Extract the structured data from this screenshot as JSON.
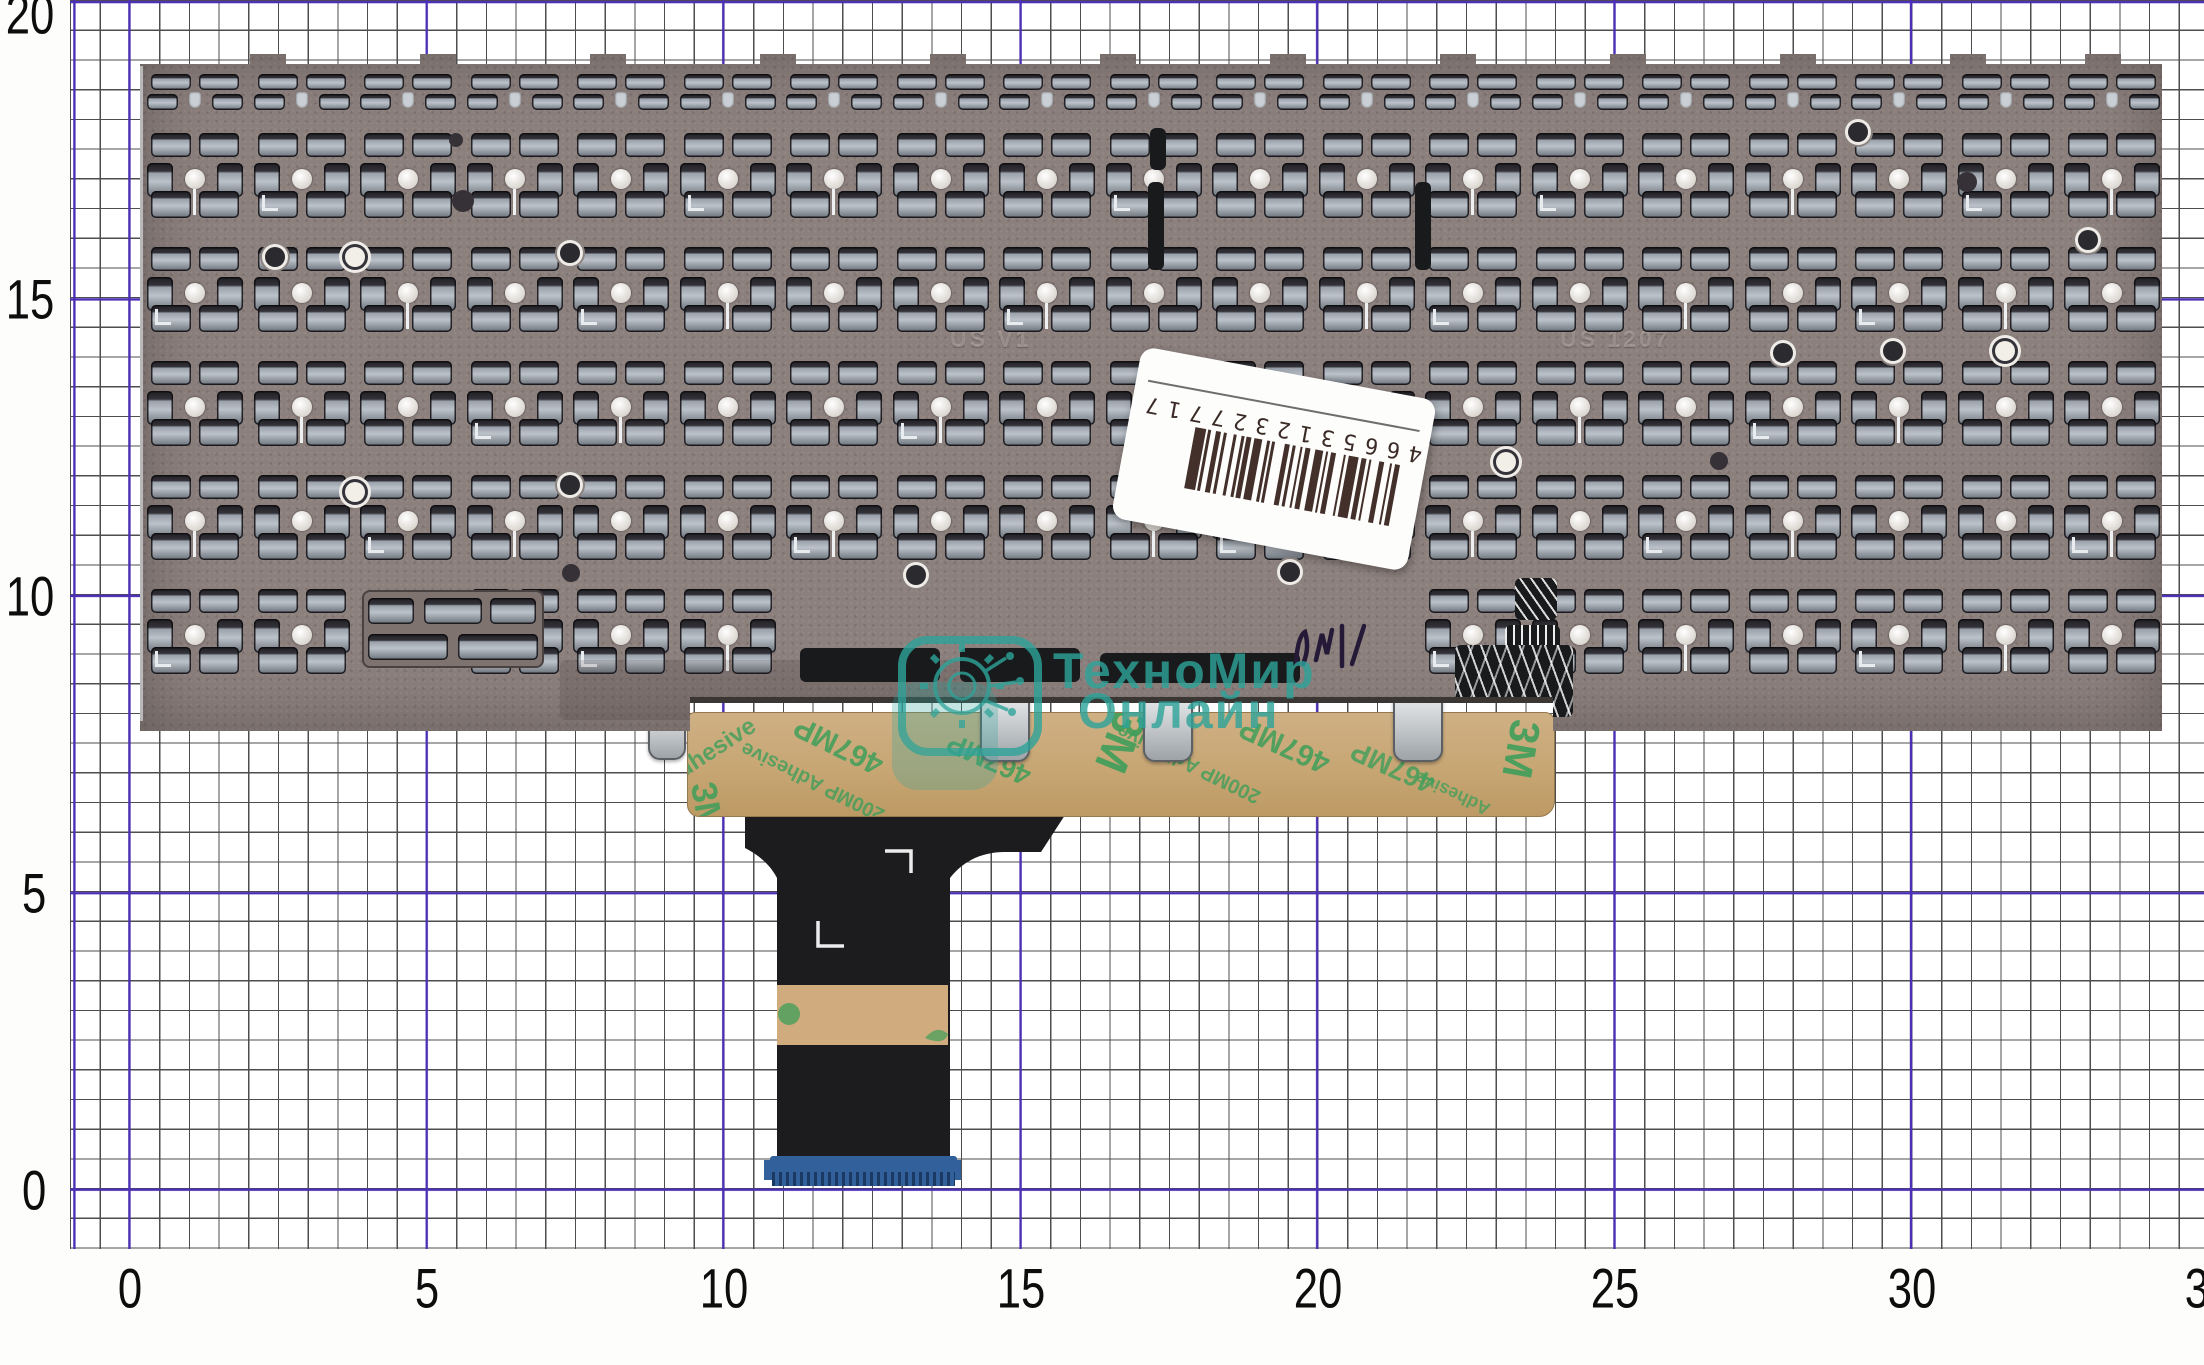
{
  "ruler": {
    "x_labels": [
      "0",
      "5",
      "10",
      "15",
      "20",
      "25",
      "30",
      "35"
    ],
    "y_labels": [
      "20",
      "15",
      "10",
      "5",
      "0"
    ],
    "grid_color_minor": "#4d4d4d",
    "grid_color_major": "#4b2fb5"
  },
  "sticker": {
    "barcode_digits": "4665312327717"
  },
  "watermark": {
    "line1": "ТехноМир",
    "line2": "Онлайн",
    "color": "#2da49a"
  },
  "tape": {
    "texts": [
      "3M",
      "467MP",
      "200MP Adhesive",
      "Adhesive"
    ],
    "color": "#c7a674",
    "text_color": "#3f9e5a"
  },
  "plate": {
    "engraving_left": "US V1",
    "engraving_right": "US 1207",
    "color": "#8c807d"
  },
  "cable": {
    "connector_color": "#31609a"
  }
}
